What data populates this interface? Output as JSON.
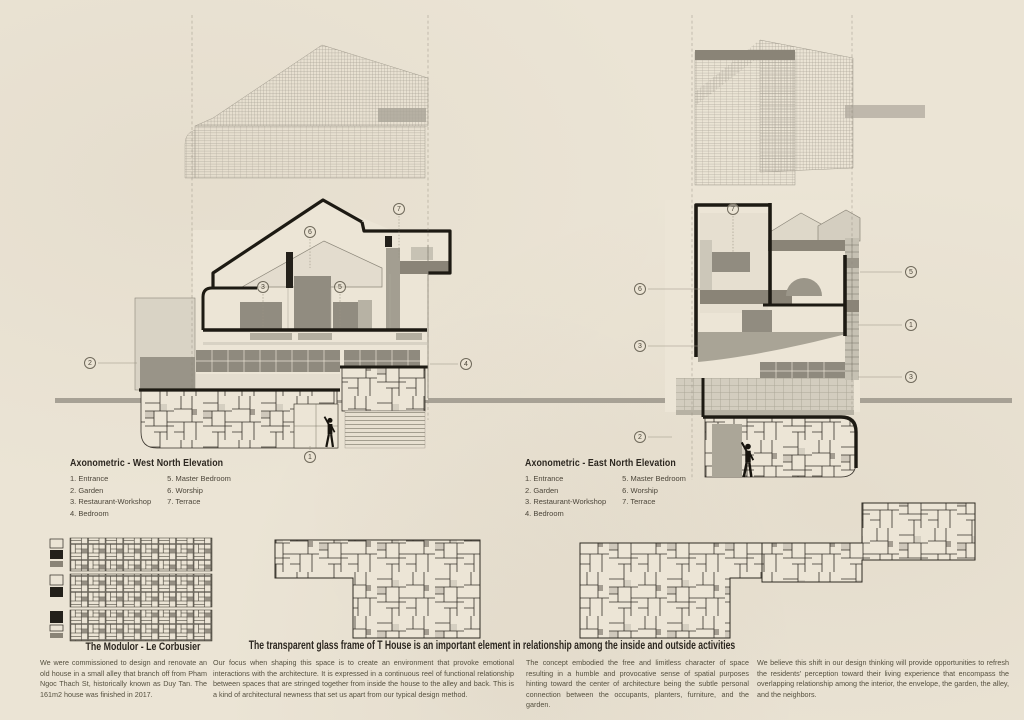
{
  "palette": {
    "background": "#ebe4d5",
    "ink": "#1d1a13",
    "gray_mid": "#918c80",
    "gray_light": "#ccc7b9",
    "ground_bar": "#a7a195",
    "body_text": "#55503f"
  },
  "legend_west": {
    "title": "Axonometric - West North Elevation",
    "items_col1": [
      "1. Entrance",
      "2. Garden",
      "3. Restaurant-Workshop",
      "4. Bedroom"
    ],
    "items_col2": [
      "5. Master Bedroom",
      "6. Worship",
      "7. Terrace"
    ]
  },
  "legend_east": {
    "title": "Axonometric - East North Elevation",
    "items_col1": [
      "1. Entrance",
      "2. Garden",
      "3. Restaurant-Workshop",
      "4. Bedroom"
    ],
    "items_col2": [
      "5. Master Bedroom",
      "6. Worship",
      "7. Terrace"
    ]
  },
  "left_callouts": [
    "1",
    "2",
    "3",
    "4",
    "5",
    "6",
    "7"
  ],
  "right_callouts": [
    "7",
    "6",
    "5",
    "1",
    "3",
    "3",
    "2"
  ],
  "modulor": {
    "title": "The Modulor - Le Corbusier",
    "paragraph": "We were commissioned to design and renovate an old house in a small alley that branch off from Pham Ngoc Thach St, historically known as Duy Tan. The 161m2 house was finished in 2017."
  },
  "statement": {
    "title": "The transparent glass frame of T House is an important element in relationship among the inside and outside activities",
    "col1": "Our focus when shaping this space is to create an environment that provoke emotional interactions with the architecture. It is expressed in a continuous reel of functional relationship between spaces that are stringed together from inside the house to the alley and back. This is a kind of architectural newness that set us apart from our typical design method.",
    "col2": "The concept embodied the free and limitless character of space resulting in a humble and provocative sense of spatial purposes hinting toward the center of architecture being the subtle personal connection between the occupants, planters, furniture, and the garden.",
    "col3": "We believe this shift in our design thinking will provide opportunities to refresh the residents' perception toward their living experience that encompass the overlapping relationship among the interior, the envelope, the garden, the alley, and the neighbors."
  }
}
